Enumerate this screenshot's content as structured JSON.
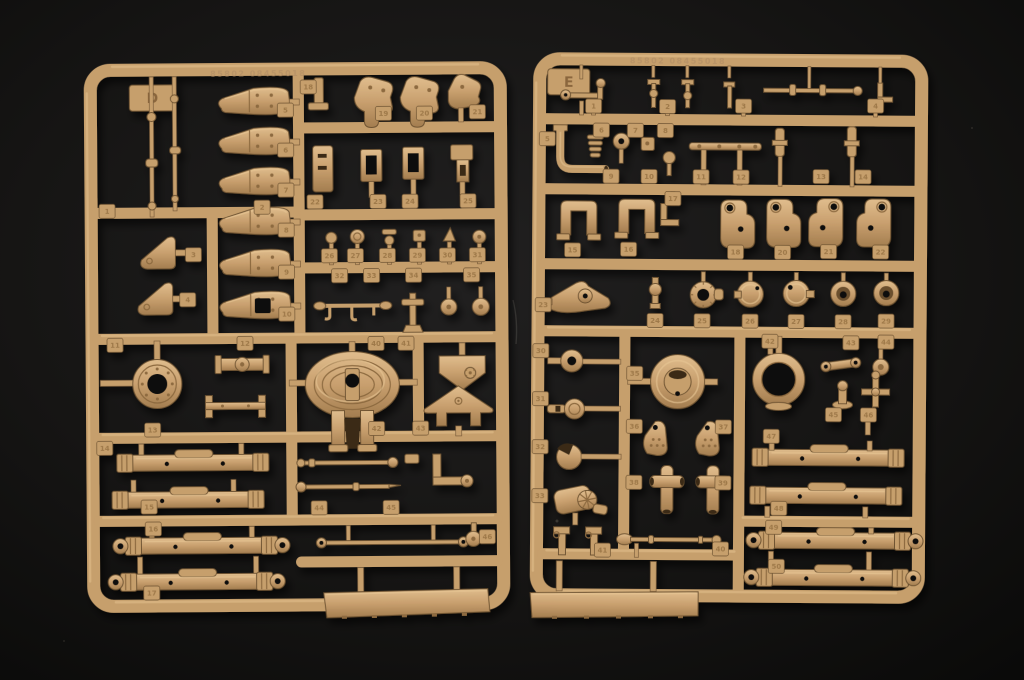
{
  "scene": {
    "type": "photograph",
    "subject": "Two tan injection-molded plastic model kit sprues (runners D and E) full of unassembled parts, lying on a black surface",
    "background_color": "#131211",
    "plastic_base_color": "#c69f6c",
    "plastic_highlight_color": "#e8c795",
    "plastic_shadow_color": "#8d6a3f"
  },
  "sprue_d": {
    "label": "D",
    "mold_text": "85802 08455018",
    "contents": [
      "letter tab D",
      "6 tapered bolted cover fittings",
      "2 thin linkage rods",
      "2 triangular gusset brackets",
      "3 flat mounting brackets",
      "rectangular frame parts",
      "6 small knob and valve parts",
      "row of tiny linkages",
      "large sprocket hub with center hole",
      "oval gun mantlet with concentric rings and legs",
      "pentagonal shield plate",
      "gabled bracket plate",
      "4 cylindrical torsion-bar axles",
      "2 tapered push rods",
      "long tie rod with eye ends",
      "long hull strip"
    ],
    "tabs": [
      {
        "n": "1",
        "x": 108,
        "y": 210
      },
      {
        "n": "2",
        "x": 263,
        "y": 207
      },
      {
        "n": "3",
        "x": 194,
        "y": 254
      },
      {
        "n": "4",
        "x": 188,
        "y": 299
      },
      {
        "n": "5",
        "x": 287,
        "y": 110
      },
      {
        "n": "6",
        "x": 287,
        "y": 150
      },
      {
        "n": "7",
        "x": 287,
        "y": 190
      },
      {
        "n": "8",
        "x": 287,
        "y": 230
      },
      {
        "n": "9",
        "x": 287,
        "y": 272
      },
      {
        "n": "10",
        "x": 287,
        "y": 314
      },
      {
        "n": "18",
        "x": 310,
        "y": 87
      },
      {
        "n": "19",
        "x": 385,
        "y": 114
      },
      {
        "n": "20",
        "x": 426,
        "y": 114
      },
      {
        "n": "21",
        "x": 479,
        "y": 113
      },
      {
        "n": "22",
        "x": 316,
        "y": 202
      },
      {
        "n": "23",
        "x": 379,
        "y": 202
      },
      {
        "n": "24",
        "x": 411,
        "y": 202
      },
      {
        "n": "25",
        "x": 469,
        "y": 202
      },
      {
        "n": "26",
        "x": 330,
        "y": 256
      },
      {
        "n": "27",
        "x": 356,
        "y": 256
      },
      {
        "n": "28",
        "x": 388,
        "y": 256
      },
      {
        "n": "29",
        "x": 418,
        "y": 256
      },
      {
        "n": "30",
        "x": 448,
        "y": 256
      },
      {
        "n": "31",
        "x": 478,
        "y": 256
      },
      {
        "n": "32",
        "x": 340,
        "y": 276
      },
      {
        "n": "33",
        "x": 372,
        "y": 276
      },
      {
        "n": "34",
        "x": 414,
        "y": 276
      },
      {
        "n": "35",
        "x": 472,
        "y": 276
      },
      {
        "n": "11",
        "x": 115,
        "y": 344
      },
      {
        "n": "12",
        "x": 245,
        "y": 343
      },
      {
        "n": "40",
        "x": 376,
        "y": 344
      },
      {
        "n": "41",
        "x": 406,
        "y": 344
      },
      {
        "n": "13",
        "x": 152,
        "y": 429
      },
      {
        "n": "42",
        "x": 376,
        "y": 429
      },
      {
        "n": "43",
        "x": 420,
        "y": 429
      },
      {
        "n": "14",
        "x": 104,
        "y": 447
      },
      {
        "n": "44",
        "x": 318,
        "y": 508
      },
      {
        "n": "45",
        "x": 390,
        "y": 508
      },
      {
        "n": "15",
        "x": 148,
        "y": 506
      },
      {
        "n": "16",
        "x": 152,
        "y": 528
      },
      {
        "n": "17",
        "x": 150,
        "y": 592
      },
      {
        "n": "46",
        "x": 486,
        "y": 538
      }
    ]
  },
  "sprue_e": {
    "label": "E",
    "mold_text": "85802 08455018",
    "contents": [
      "letter tab E",
      "row of small cranks and valve studs",
      "elbow pipe",
      "finned cone",
      "bolted cross-bar",
      "2 U-shaped brackets",
      "4 suspension knuckle brackets",
      "angled control arm",
      "toothed ring",
      "2 domed caps",
      "2 funnel cups",
      "road-wheel hub",
      "large bearing ring",
      "2 gusset plates with bolt detail",
      "2 T-pipe fittings",
      "hub grommet",
      "stemmed disc",
      "open drum housing",
      "final-drive gearbox",
      "small linkages and flanged studs",
      "4 cylindrical torsion-bar axles",
      "tapered barrel rod",
      "long hull strip"
    ],
    "tabs": [
      {
        "n": "1",
        "x": 592,
        "y": 107
      },
      {
        "n": "2",
        "x": 666,
        "y": 107
      },
      {
        "n": "3",
        "x": 742,
        "y": 106
      },
      {
        "n": "4",
        "x": 874,
        "y": 105
      },
      {
        "n": "5",
        "x": 546,
        "y": 140
      },
      {
        "n": "6",
        "x": 600,
        "y": 131
      },
      {
        "n": "7",
        "x": 634,
        "y": 131
      },
      {
        "n": "8",
        "x": 664,
        "y": 131
      },
      {
        "n": "9",
        "x": 610,
        "y": 177
      },
      {
        "n": "10",
        "x": 648,
        "y": 177
      },
      {
        "n": "11",
        "x": 700,
        "y": 177
      },
      {
        "n": "12",
        "x": 740,
        "y": 177
      },
      {
        "n": "13",
        "x": 820,
        "y": 176
      },
      {
        "n": "14",
        "x": 862,
        "y": 176
      },
      {
        "n": "15",
        "x": 572,
        "y": 251
      },
      {
        "n": "16",
        "x": 628,
        "y": 250
      },
      {
        "n": "17",
        "x": 672,
        "y": 199
      },
      {
        "n": "18",
        "x": 735,
        "y": 252
      },
      {
        "n": "20",
        "x": 782,
        "y": 252
      },
      {
        "n": "21",
        "x": 828,
        "y": 251
      },
      {
        "n": "22",
        "x": 880,
        "y": 251
      },
      {
        "n": "23",
        "x": 543,
        "y": 306
      },
      {
        "n": "24",
        "x": 655,
        "y": 321
      },
      {
        "n": "25",
        "x": 702,
        "y": 321
      },
      {
        "n": "26",
        "x": 750,
        "y": 321
      },
      {
        "n": "27",
        "x": 796,
        "y": 321
      },
      {
        "n": "28",
        "x": 843,
        "y": 321
      },
      {
        "n": "29",
        "x": 886,
        "y": 320
      },
      {
        "n": "30",
        "x": 541,
        "y": 352
      },
      {
        "n": "31",
        "x": 541,
        "y": 400
      },
      {
        "n": "32",
        "x": 541,
        "y": 448
      },
      {
        "n": "33",
        "x": 541,
        "y": 497
      },
      {
        "n": "35",
        "x": 635,
        "y": 374
      },
      {
        "n": "36",
        "x": 635,
        "y": 427
      },
      {
        "n": "37",
        "x": 724,
        "y": 427
      },
      {
        "n": "38",
        "x": 635,
        "y": 483
      },
      {
        "n": "39",
        "x": 724,
        "y": 483
      },
      {
        "n": "42",
        "x": 770,
        "y": 341
      },
      {
        "n": "43",
        "x": 851,
        "y": 342
      },
      {
        "n": "44",
        "x": 886,
        "y": 341
      },
      {
        "n": "45",
        "x": 834,
        "y": 414
      },
      {
        "n": "46",
        "x": 869,
        "y": 414
      },
      {
        "n": "41",
        "x": 604,
        "y": 551
      },
      {
        "n": "40",
        "x": 722,
        "y": 549
      },
      {
        "n": "47",
        "x": 772,
        "y": 436
      },
      {
        "n": "48",
        "x": 780,
        "y": 508
      },
      {
        "n": "49",
        "x": 775,
        "y": 527
      },
      {
        "n": "50",
        "x": 778,
        "y": 566
      }
    ]
  }
}
